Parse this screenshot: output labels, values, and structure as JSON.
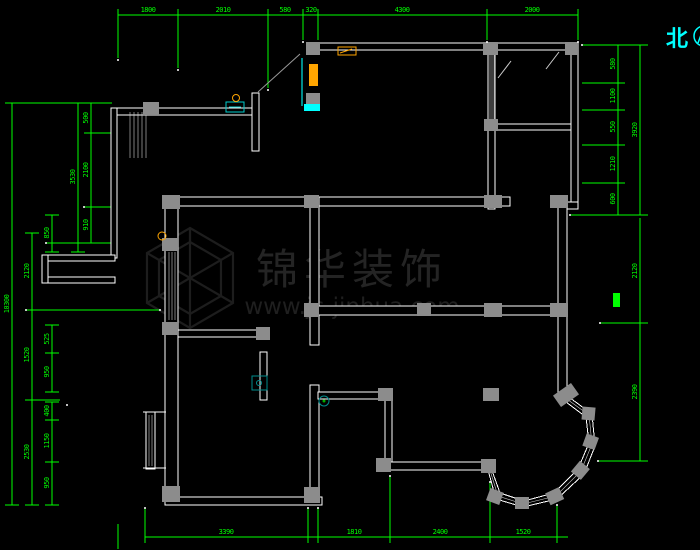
{
  "north": {
    "label": "北"
  },
  "watermark": {
    "brand": "锦华装饰",
    "url": "www.js-jinhua.com"
  },
  "dims": {
    "top": [
      "1800",
      "2010",
      "580",
      "320",
      "4300",
      "2000"
    ],
    "bottom": [
      "3390",
      "1810",
      "2400",
      "1520"
    ],
    "left_overall": "10300",
    "left_mid": [
      "2120",
      "1520",
      "2530"
    ],
    "left_small_a": "850",
    "left_small_b": [
      "525",
      "950"
    ],
    "left_small_c": [
      "400",
      "1150",
      "950"
    ],
    "left_inner_overall": "3530",
    "left_inner": [
      "500",
      "2100",
      "910"
    ],
    "right_inner": [
      "580",
      "1100",
      "550",
      "1210",
      "600"
    ],
    "right_outer": [
      "3920",
      "2120",
      "2390"
    ]
  },
  "colors": {
    "background": "#000000",
    "wall": "#ffffff",
    "dimension_green": "#00ff00",
    "north_cyan": "#00ffff",
    "column_gray": "#8c8c8c",
    "accent_orange": "#ffa500",
    "accent_cyan": "#00ffff",
    "accent_teal": "#008b8b",
    "watermark_gray": "#242424"
  }
}
